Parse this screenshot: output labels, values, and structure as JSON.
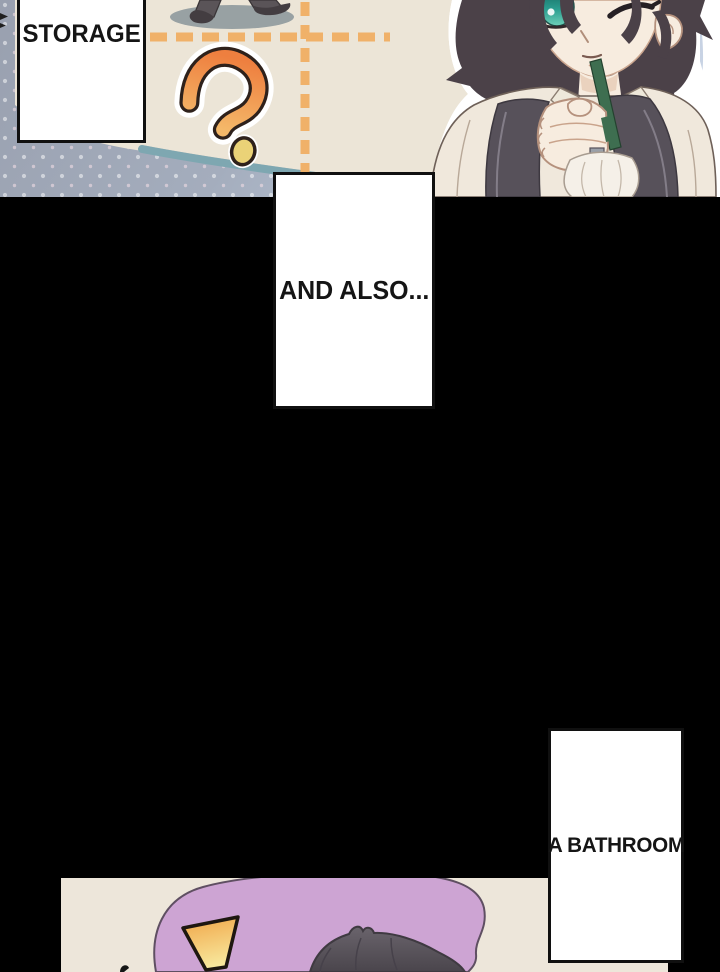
{
  "page": {
    "width": 720,
    "height": 972,
    "background": "#000000"
  },
  "speech": {
    "storage": "STORAGE",
    "and_also": "AND ALSO...",
    "bathroom": "A BATHROOM"
  },
  "top_panel": {
    "description": "floor-plan map panel: walking figure legs on a shadow, orange dashed partition lines, large orange question mark, dotted blue background, character in vest holding a green pencil while thinking",
    "icon": "question-mark-icon",
    "colors": {
      "map_beige": "#ece5d7",
      "dotted_bg_dark": "#99a0af",
      "dotted_bg_light": "#c8d3e4",
      "dot_white": "#ffffff",
      "dot_pink": "#f0dce4",
      "dash_orange": "#f0b169",
      "border_curve_teal": "#7ea7b1",
      "figure_shadow": "#98a1a3",
      "figure_pants": "#5a5458",
      "figure_shoes": "#433d41",
      "question_orange_top": "#ee7f3f",
      "question_orange_bottom": "#f4b869",
      "question_dot_yellow": "#ead277",
      "outline_dark": "#2e211b"
    }
  },
  "character": {
    "description": "dark-haired character winking, one teal eye open, holding green pencil to chin, white shirt, dark vest straps, white ribbon jabot",
    "colors": {
      "hair": "#4b4148",
      "skin": "#f7ecdf",
      "eye_teal": "#2a9d8f",
      "shirt": "#f0e8dc",
      "vest": "#57515a",
      "pencil_green": "#3e6e50",
      "ribbon": "#f5f0e8",
      "halo": "#ffffff"
    }
  },
  "bottom_panel": {
    "description": "start of reaction panel: purple surprise blob, orange exclamation point, top of a dark-haired head",
    "icon": "exclamation-icon",
    "colors": {
      "bg_beige": "#ede6da",
      "blob_purple": "#cda4d3",
      "blob_outline": "#5f4f62",
      "exclaim_orange": "#f0a446",
      "exclaim_yellow": "#f8e79c",
      "hair_gray": "#5d5760"
    }
  }
}
